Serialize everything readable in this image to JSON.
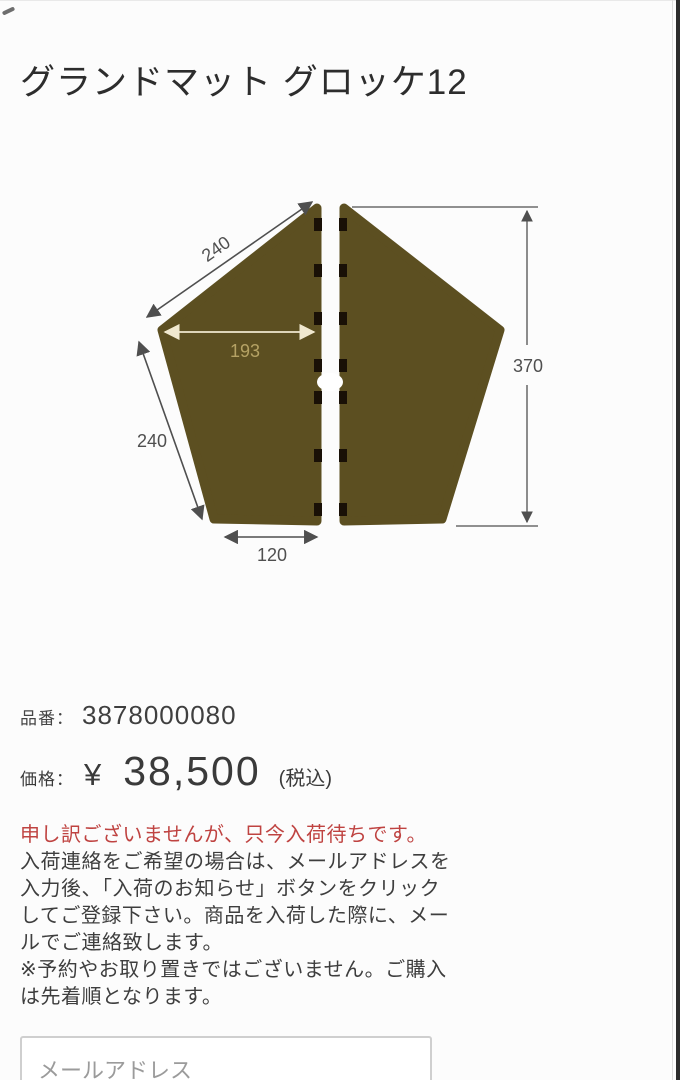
{
  "page": {
    "title": "グランドマット グロッケ12"
  },
  "diagram": {
    "dimensions": {
      "top_edge": "240",
      "half_width": "193",
      "lower_edge": "240",
      "bottom_width": "120",
      "height": "370"
    },
    "colors": {
      "mat": "#5c4f21",
      "tab": "#191006",
      "dim_line": "#4f4f4f",
      "inner_line": "#f0e8cf",
      "inner_label": "#b5a264"
    }
  },
  "product": {
    "part_label": "品番：",
    "part_number": "3878000080",
    "price_label": "価格：",
    "currency": "¥",
    "amount": "38,500",
    "tax_note": "(税込)"
  },
  "notice": {
    "alert": "申し訳ございませんが、只今入荷待ちです。",
    "lines": [
      "入荷連絡をご希望の場合は、メールアドレスを",
      "入力後、「入荷のお知らせ」ボタンをクリック",
      "してご登録下さい。商品を入荷した際に、メー",
      "ルでご連絡致します。",
      "※予約やお取り置きではございません。ご購入",
      "は先着順となります。"
    ]
  },
  "email_form": {
    "placeholder": "メールアドレス"
  }
}
